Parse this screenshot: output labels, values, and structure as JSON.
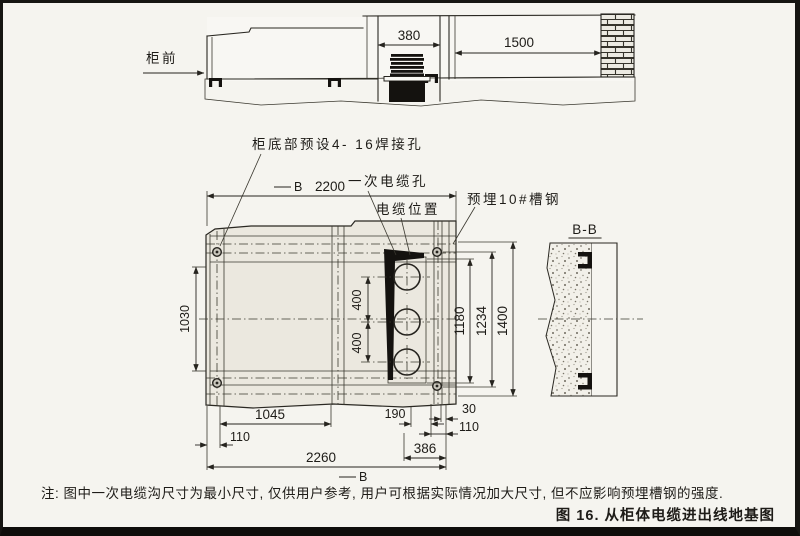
{
  "colors": {
    "ink": "#26241f",
    "paper": "#f5f4ef",
    "panel_fill": "#ebe8df",
    "black_fill": "#14120f"
  },
  "side_view": {
    "front_label": "柜前",
    "dim_duct_width": "380",
    "dim_rear_gap": "1500"
  },
  "plan_view": {
    "label_welding_holes": "柜底部预设4- 16焊接孔",
    "label_primary_cable_hole": "一次电缆孔",
    "label_cable_position": "电缆位置",
    "label_embedded_channel": "预埋10#槽钢",
    "section_marker_top": "B",
    "section_marker_bottom": "B",
    "dim_width_top": "2200",
    "dim_left_height": "1030",
    "dim_hole_gap_upper": "400",
    "dim_hole_gap_lower": "400",
    "dim_right_inner": "1180",
    "dim_right_middle": "1234",
    "dim_right_outer": "1400",
    "dim_bottom_segment": "1045",
    "dim_bottom_190": "190",
    "dim_bottom_30": "30",
    "dim_bottom_110_left": "110",
    "dim_bottom_110_right": "110",
    "dim_bottom_386": "386",
    "dim_bottom_total": "2260"
  },
  "section_view": {
    "title": "B-B"
  },
  "note": "注: 图中一次电缆沟尺寸为最小尺寸, 仅供用户参考, 用户可根据实际情况加大尺寸, 但不应影响预埋槽钢的强度.",
  "caption": "图 16. 从柜体电缆进出线地基图"
}
